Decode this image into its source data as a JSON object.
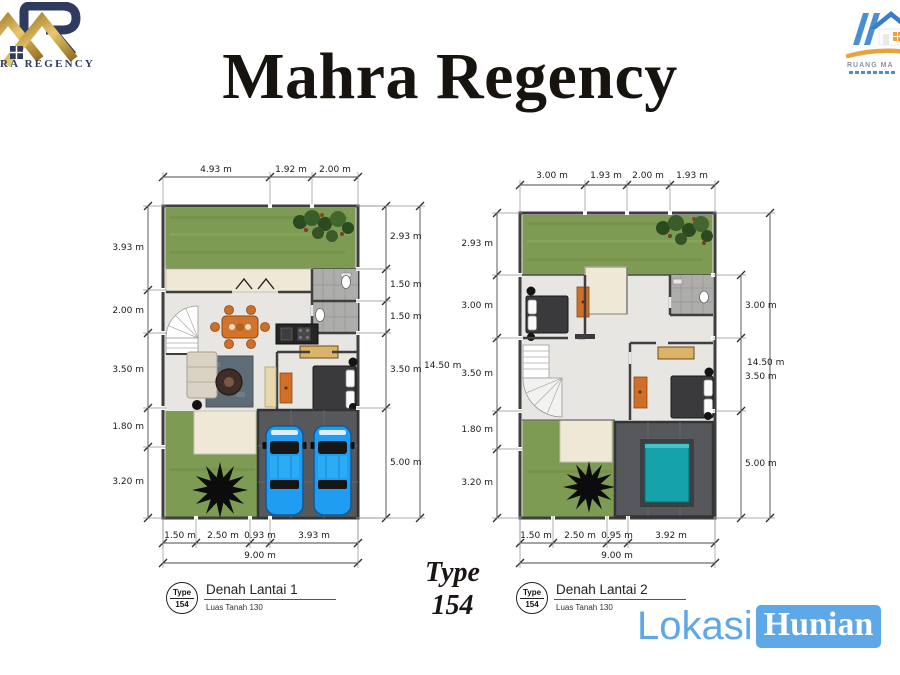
{
  "header": {
    "title": "Mahra Regency"
  },
  "logos": {
    "left": {
      "visible_text": "RA REGENCY",
      "navy": "#2e3b5e",
      "gold": "#c49a3c"
    },
    "right": {
      "visible_text": "RUANG MA",
      "blue": "#4a8fd4",
      "gold": "#e8a33d"
    }
  },
  "plans": {
    "plan1": {
      "dims_top": [
        "4.93 m",
        "1.92 m",
        "2.00 m"
      ],
      "dims_left": [
        "3.93 m",
        "2.00 m",
        "3.50 m",
        "1.80 m",
        "3.20 m"
      ],
      "dims_right": [
        "2.93 m",
        "1.50 m",
        "1.50 m",
        "3.50 m",
        "5.00 m"
      ],
      "dim_right_total": "14.50 m",
      "dims_bottom": [
        "1.50 m",
        "2.50 m",
        "0.93 m",
        "3.93 m"
      ],
      "dim_bottom_total": "9.00 m",
      "label": {
        "type_word": "Type",
        "type_number": "154",
        "title": "Denah Lantai 1",
        "subtitle": "Luas Tanah 130"
      }
    },
    "plan2": {
      "dims_top": [
        "3.00 m",
        "1.93 m",
        "2.00 m",
        "1.93 m"
      ],
      "dims_left": [
        "2.93 m",
        "3.00 m",
        "3.50 m",
        "1.80 m",
        "3.20 m"
      ],
      "dims_right": [
        "3.00 m",
        "3.50 m",
        "5.00 m"
      ],
      "dim_right_total": "14.50 m",
      "dims_bottom": [
        "1.50 m",
        "2.50 m",
        "0.95 m",
        "3.92 m"
      ],
      "dim_bottom_total": "9.00 m",
      "label": {
        "type_word": "Type",
        "type_number": "154",
        "title": "Denah Lantai 2",
        "subtitle": "Luas Tanah 130"
      }
    }
  },
  "center_label": {
    "line1": "Type",
    "line2": "154"
  },
  "watermark": {
    "part1": "Lokasi",
    "part2": "Hunian",
    "color": "#5fa8e8"
  },
  "colors": {
    "grass": "#7d9b52",
    "floor": "#e7e6e3",
    "wall": "#3f3f3f",
    "garage": "#56585b",
    "car_blue": "#1f9df0",
    "pool_teal": "#16a2a9",
    "terrace": "#efe8d7",
    "furniture_orange": "#cf6f28",
    "wood": "#dcb469",
    "dim_line": "#4a4a4a"
  }
}
